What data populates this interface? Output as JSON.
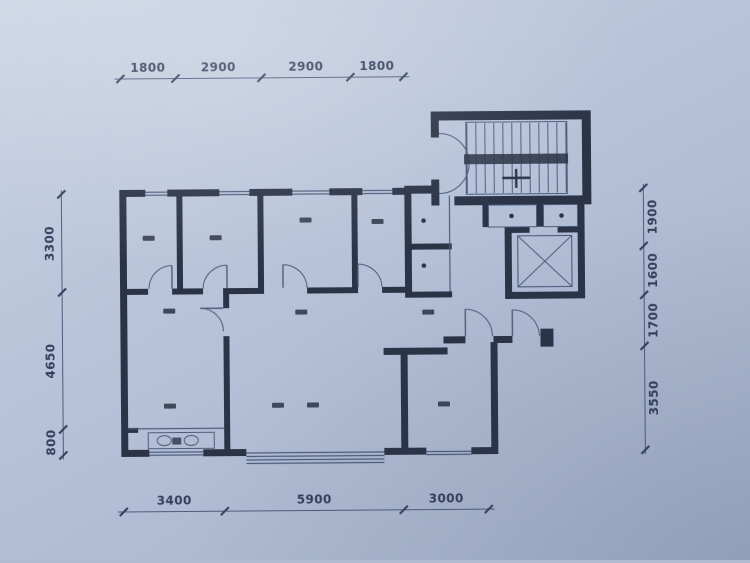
{
  "colors": {
    "paper": "#b7c3d9",
    "ink": "#2b3347",
    "thin_line": "#4e5c7e",
    "dim_text": "#333f5c"
  },
  "dimensions": {
    "top": [
      "1800",
      "2900",
      "2900",
      "1800"
    ],
    "bottom": [
      "3400",
      "5900",
      "3000"
    ],
    "left": [
      "3300",
      "4650",
      "800"
    ],
    "right": [
      "1900",
      "1600",
      "1700",
      "3550"
    ]
  }
}
